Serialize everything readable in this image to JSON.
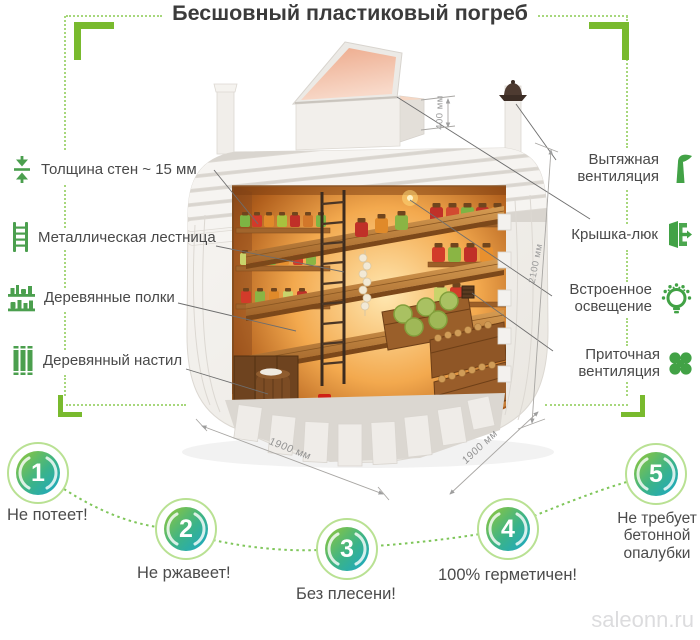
{
  "title": "Бесшовный пластиковый погреб",
  "left_labels": [
    {
      "icon": "wall-thickness-icon",
      "label": "Толщина стен ~ 15 мм"
    },
    {
      "icon": "metal-ladder-icon",
      "label": "Металлическая лестница"
    },
    {
      "icon": "wooden-shelves-icon",
      "label": "Деревянные полки"
    },
    {
      "icon": "wooden-floor-icon",
      "label": "Деревянный настил"
    }
  ],
  "right_labels": [
    {
      "icon": "exhaust-vent-icon",
      "label": "Вытяжная вентиляция"
    },
    {
      "icon": "hatch-cover-icon",
      "label": "Крышка-люк"
    },
    {
      "icon": "built-in-lighting-icon",
      "label": "Встроенное освещение"
    },
    {
      "icon": "supply-vent-icon",
      "label": "Приточная вентиляция"
    }
  ],
  "dimensions": {
    "hatch_height": "400 мм",
    "body_height": "2100 мм",
    "width_front": "1900 мм",
    "depth_side": "1900 мм"
  },
  "benefits": [
    {
      "number": "1",
      "label": "Не потеет!"
    },
    {
      "number": "2",
      "label": "Не ржавеет!"
    },
    {
      "number": "3",
      "label": "Без плесени!"
    },
    {
      "number": "4",
      "label": "100% герметичен!"
    },
    {
      "number": "5",
      "label": "Не требует бетонной опалубки"
    }
  ],
  "watermark": "saleonn.ru",
  "colors": {
    "accent_green": "#79ba2e",
    "dotted_green": "#a7d77c",
    "icon_green": "#4b9f4e",
    "badge_gradient_start": "#8dc63f",
    "badge_gradient_end": "#1aa7c9",
    "label_text": "#494949",
    "title_text": "#3b3b3b",
    "dimension_text": "#9b9b9b",
    "watermark_text": "#dcdcde"
  }
}
